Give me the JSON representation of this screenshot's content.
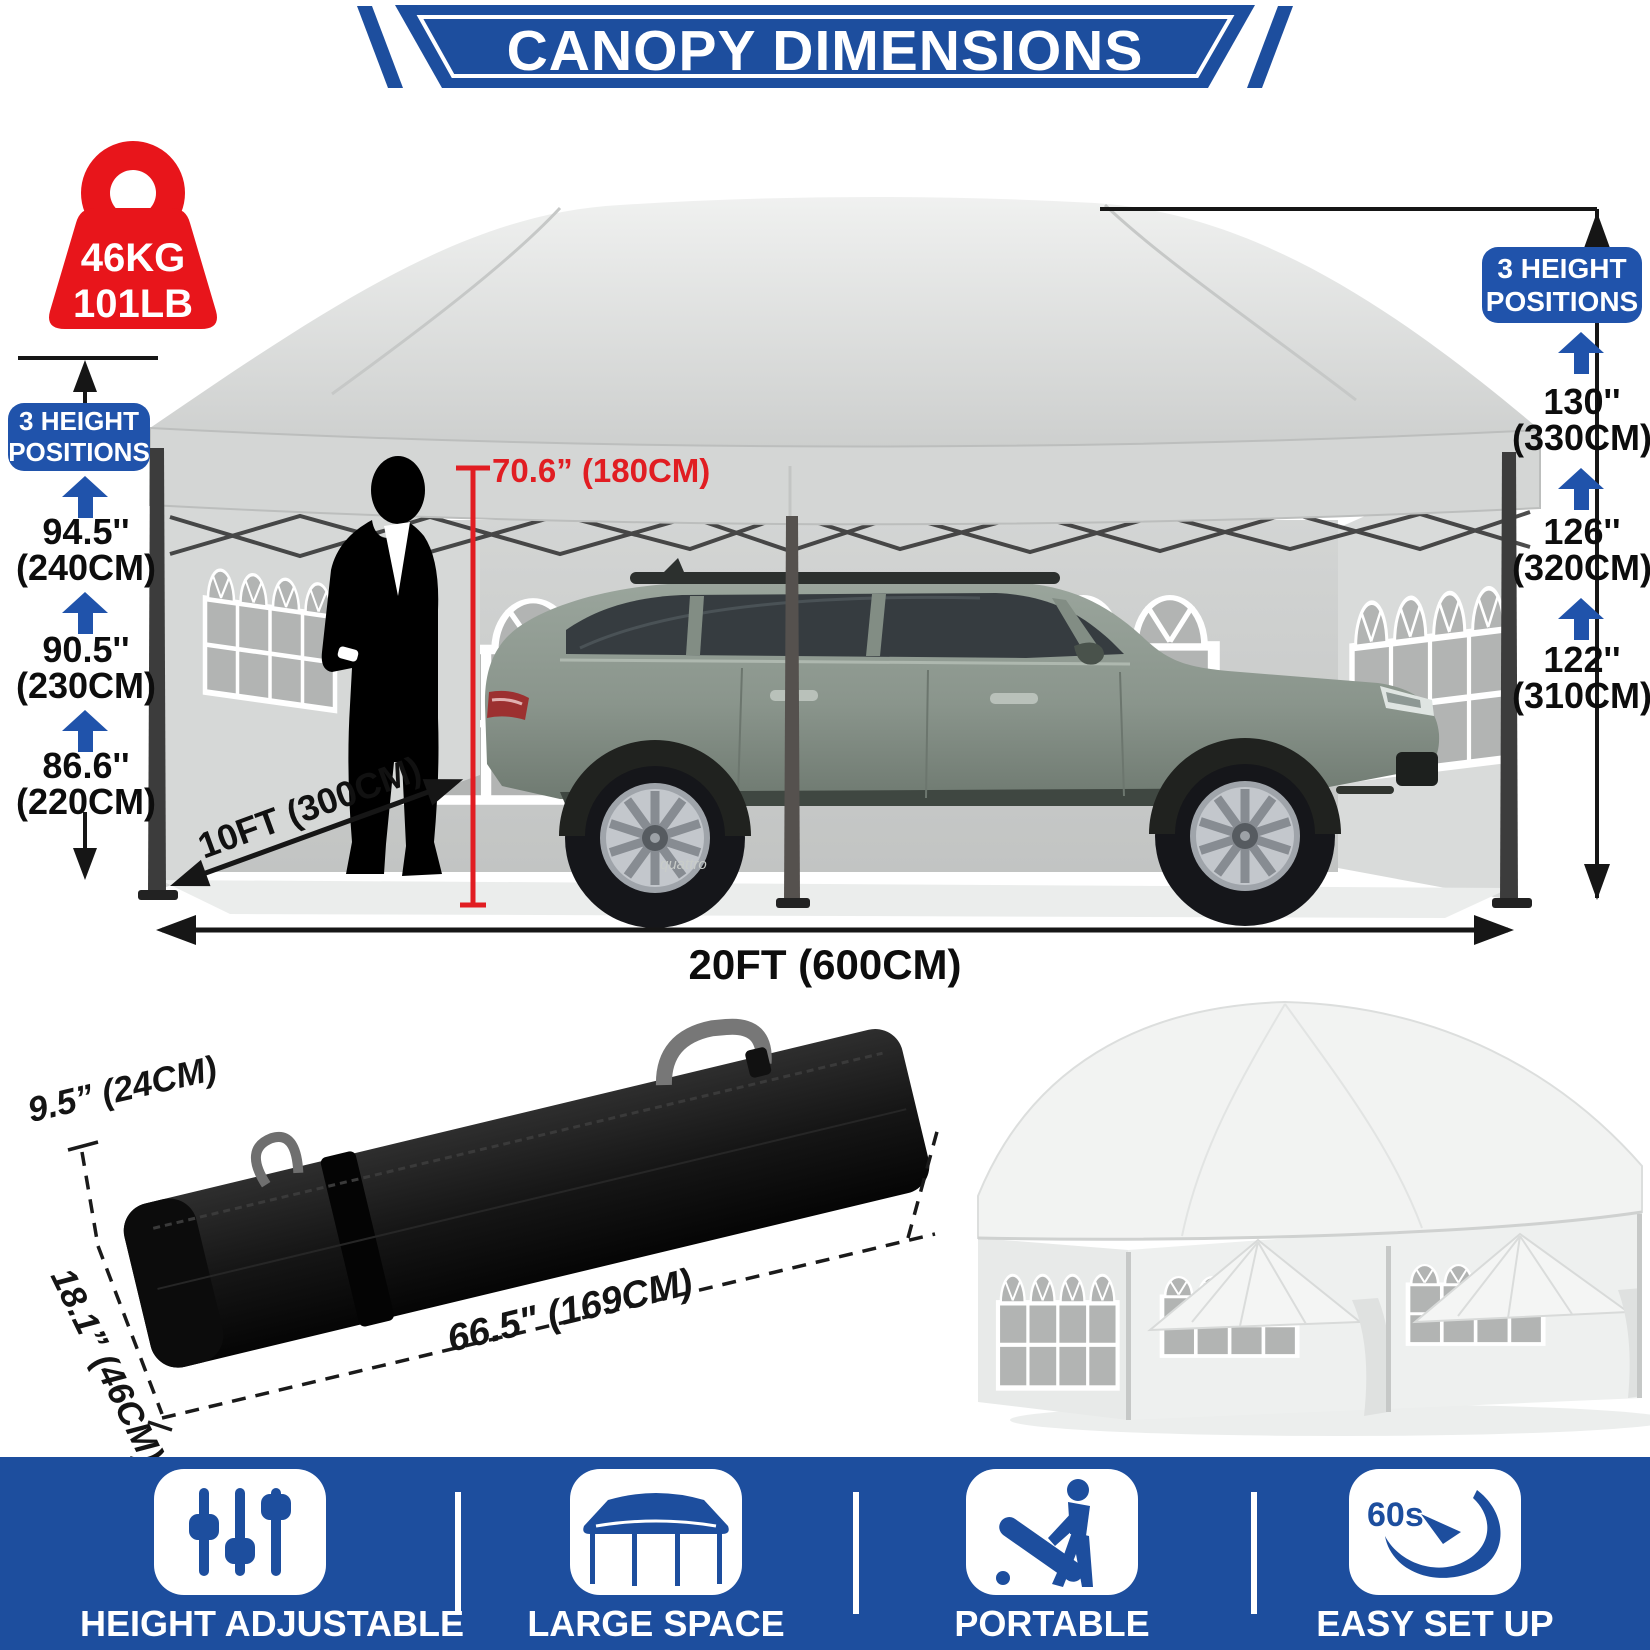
{
  "banner": {
    "title": "CANOPY DIMENSIONS"
  },
  "weight_badge": {
    "kg": "46KG",
    "lb": "101LB"
  },
  "left_heights": {
    "badge": "3 HEIGHT POSITIONS",
    "items": [
      {
        "inches": "94.5''",
        "cm": "(240CM)"
      },
      {
        "inches": "90.5''",
        "cm": "(230CM)"
      },
      {
        "inches": "86.6''",
        "cm": "(220CM)"
      }
    ]
  },
  "right_heights": {
    "badge": "3 HEIGHT POSITIONS",
    "items": [
      {
        "inches": "130''",
        "cm": "(330CM)"
      },
      {
        "inches": "126''",
        "cm": "(320CM)"
      },
      {
        "inches": "122''",
        "cm": "(310CM)"
      }
    ]
  },
  "scene": {
    "person_height": "70.6” (180CM)",
    "depth": "10FT (300CM)",
    "width": "20FT (600CM)",
    "car_badge": "quattro"
  },
  "bag": {
    "height": "9.5” (24CM)",
    "depth": "18.1” (46CM)",
    "length": "66.5\" (169CM)"
  },
  "features": {
    "items": [
      {
        "icon": "sliders-icon",
        "label": "HEIGHT ADJUSTABLE"
      },
      {
        "icon": "canopy-icon",
        "label": "LARGE SPACE"
      },
      {
        "icon": "portable-icon",
        "label": "PORTABLE"
      },
      {
        "icon": "easy-setup-icon",
        "label": "EASY SET UP",
        "icon_text": "60s"
      }
    ]
  },
  "colors": {
    "blue": "#1d4e9e",
    "red": "#e8151b",
    "red_line": "#e11d22"
  }
}
